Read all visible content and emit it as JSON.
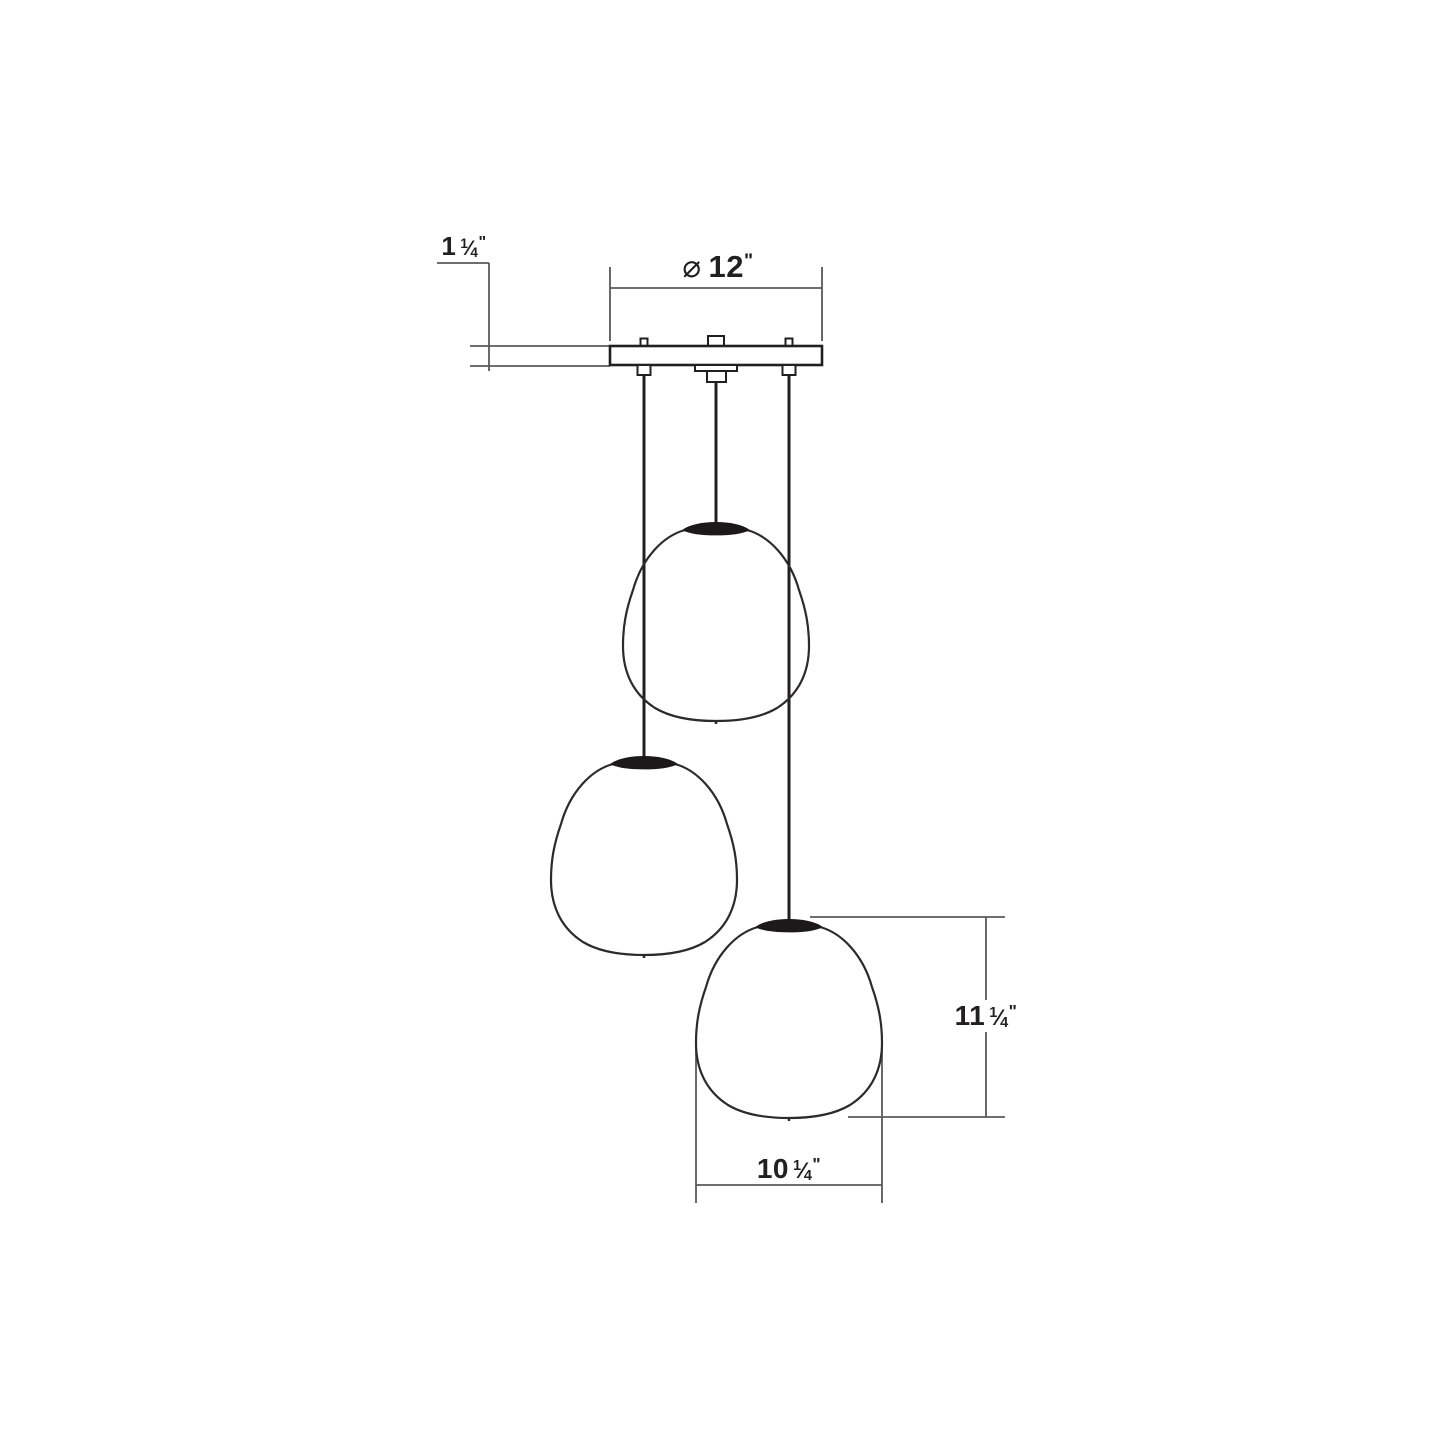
{
  "diagram": {
    "kind": "pendant-light-dimension-drawing",
    "pendant_count": 3,
    "dimensions": {
      "canopy_height": {
        "whole": "1",
        "num": "1",
        "den": "4",
        "unit": "\""
      },
      "canopy_diameter": {
        "symbol": "⌀",
        "value": "12",
        "unit": "\""
      },
      "shade_height": {
        "whole": "11",
        "num": "1",
        "den": "4",
        "unit": "\""
      },
      "shade_width": {
        "whole": "10",
        "num": "1",
        "den": "4",
        "unit": "\""
      }
    },
    "glyphs": {
      "fraction_slash": "⁄"
    },
    "colors": {
      "drawing_line": "#231F20",
      "dimension_line": "#58595B",
      "cap_fill": "#1D191A",
      "background": "#FFFFFF"
    }
  }
}
